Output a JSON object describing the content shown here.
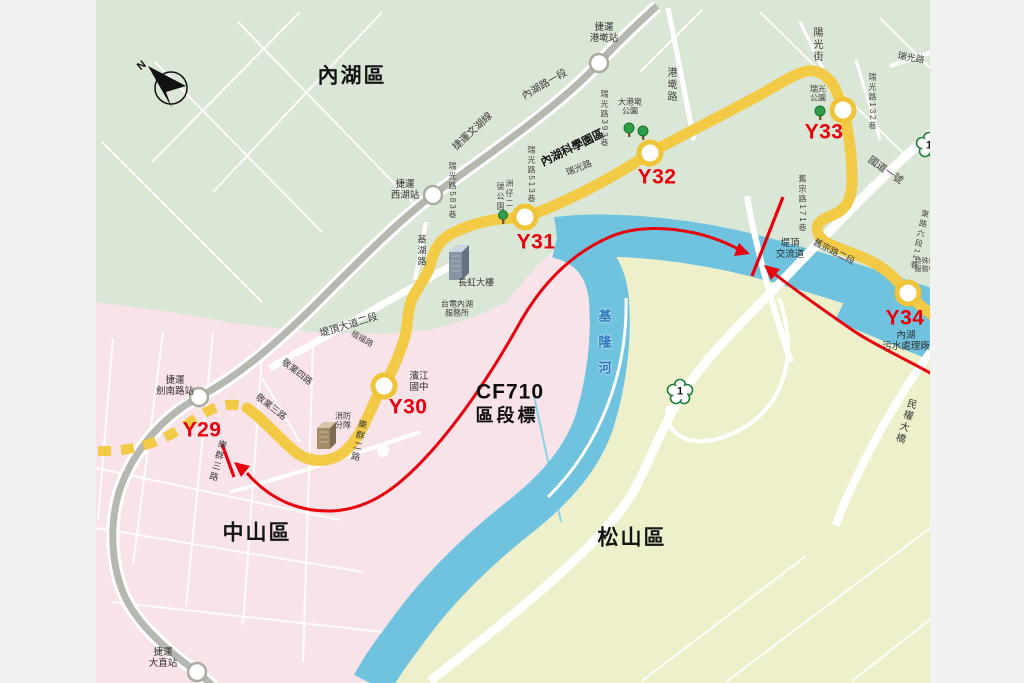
{
  "map_title": "捷運東環段 Y29-Y34 路線圖 (CF710 區段標)",
  "colors": {
    "gutter": "#f0f1f0",
    "neihu_green": "#dbe7d6",
    "zhongshan_pink": "#f8e3e8",
    "songshan_yellowgreen": "#eef0cc",
    "river_blue": "#6fc3df",
    "river_text_blue": "#2e77bc",
    "route_yellow": "#f2ca45",
    "metro_gray": "#b5b8ae",
    "marker_red": "#e8000d",
    "road_white": "#ffffff",
    "ink": "#3a3a3a"
  },
  "districts": [
    "內湖區",
    "中山區",
    "松山區"
  ],
  "route_stations": [
    "Y29",
    "Y30",
    "Y31",
    "Y32",
    "Y33",
    "Y34"
  ],
  "metro_line": "捷運文湖線",
  "metro_stations": [
    "捷運港墘站",
    "捷運西湖站",
    "捷運劍南路站",
    "捷運大直站"
  ],
  "segment_marker": {
    "code": "CF710",
    "label": "區段標"
  },
  "river": "基隆河",
  "labels": [
    {
      "n": "district-neihu",
      "t": "內湖區",
      "x": 352,
      "y": 77,
      "c": "d"
    },
    {
      "n": "district-zhongshan",
      "t": "中山區",
      "x": 257,
      "y": 534,
      "c": "d"
    },
    {
      "n": "district-songshan",
      "t": "松山區",
      "x": 632,
      "y": 539,
      "c": "d"
    },
    {
      "n": "station-y29-label",
      "t": "Y29",
      "x": 202,
      "y": 431,
      "c": "y"
    },
    {
      "n": "station-y30-label",
      "t": "Y30",
      "x": 408,
      "y": 408,
      "c": "y"
    },
    {
      "n": "station-y31-label",
      "t": "Y31",
      "x": 536,
      "y": 243,
      "c": "y"
    },
    {
      "n": "station-y32-label",
      "t": "Y32",
      "x": 657,
      "y": 178,
      "c": "y"
    },
    {
      "n": "station-y33-label",
      "t": "Y33",
      "x": 824,
      "y": 133,
      "c": "y"
    },
    {
      "n": "station-y34-label",
      "t": "Y34",
      "x": 905,
      "y": 319,
      "c": "y"
    },
    {
      "n": "cf710-code",
      "t": "CF710",
      "x": 510,
      "y": 393,
      "c": "cf1"
    },
    {
      "n": "cf710-label",
      "t": "區段標",
      "x": 507,
      "y": 416,
      "c": "cf2"
    },
    {
      "n": "river-label",
      "t": "基隆河",
      "x": 604,
      "y": 348,
      "c": "riv v"
    },
    {
      "n": "mrt-gangqian-label",
      "t": "捷運\n港墘站",
      "x": 604,
      "y": 33,
      "c": "m"
    },
    {
      "n": "mrt-xihu-label",
      "t": "捷運\n西湖站",
      "x": 405,
      "y": 190,
      "c": "m"
    },
    {
      "n": "mrt-jiannan-label",
      "t": "捷運\n劍南路站",
      "x": 175,
      "y": 386,
      "c": "m"
    },
    {
      "n": "mrt-dazhi-label",
      "t": "捷運\n大直站",
      "x": 163,
      "y": 658,
      "c": "m"
    },
    {
      "n": "road-neihu-rd-sec1",
      "t": "內湖路一段",
      "x": 545,
      "y": 85,
      "r": -30,
      "c": "r"
    },
    {
      "n": "mrt-wenhu-line-label",
      "t": "捷運文湖線",
      "x": 473,
      "y": 132,
      "r": -43,
      "c": "r"
    },
    {
      "n": "neihu-tech-park-label",
      "t": "內湖科學園區",
      "x": 573,
      "y": 149,
      "r": -26,
      "c": "bk"
    },
    {
      "n": "road-ruiguang-mid",
      "t": "瑞光路",
      "x": 579,
      "y": 168,
      "r": -22,
      "c": "r9"
    },
    {
      "n": "road-ruiguang-lane393",
      "t": "瑞光路393巷",
      "x": 604,
      "y": 119,
      "c": "r8 v"
    },
    {
      "n": "road-ruiguang-lane513",
      "t": "瑞光路513巷",
      "x": 531,
      "y": 175,
      "c": "r8 v"
    },
    {
      "n": "road-ruiguang-lane583",
      "t": "瑞光路583巷",
      "x": 452,
      "y": 191,
      "c": "r8 v"
    },
    {
      "n": "zhouzai-park-label-a",
      "t": "洲仔二",
      "x": 509,
      "y": 194,
      "c": "r8 v"
    },
    {
      "n": "zhouzai-park-label-b",
      "t": "號公園",
      "x": 500,
      "y": 197,
      "c": "r8 v"
    },
    {
      "n": "road-jihu",
      "t": "基湖路",
      "x": 421,
      "y": 251,
      "c": "r9 v"
    },
    {
      "n": "road-gangqian",
      "t": "港墘路",
      "x": 670,
      "y": 85,
      "c": "r v"
    },
    {
      "n": "dagangqian-park-label",
      "t": "大港墘\n公園",
      "x": 630,
      "y": 107,
      "c": "m8"
    },
    {
      "n": "road-yangguang-st",
      "t": "陽光街",
      "x": 816,
      "y": 45,
      "c": "r v"
    },
    {
      "n": "road-ruiguang-ne",
      "t": "瑞光路",
      "x": 911,
      "y": 58,
      "r": 10,
      "c": "r9"
    },
    {
      "n": "road-ruiguang-lane132",
      "t": "瑞光路132巷",
      "x": 872,
      "y": 102,
      "c": "r8 v"
    },
    {
      "n": "ruiguang-park-label",
      "t": "瑞光\n公園",
      "x": 818,
      "y": 94,
      "c": "m8"
    },
    {
      "n": "road-national-hwy1",
      "t": "國道一號",
      "x": 885,
      "y": 171,
      "r": 35,
      "c": "r"
    },
    {
      "n": "road-jiuzong-lane171",
      "t": "舊宗路171巷",
      "x": 802,
      "y": 204,
      "c": "r8 v"
    },
    {
      "n": "road-jiuzong-sec2",
      "t": "舊宗路二段",
      "x": 834,
      "y": 252,
      "r": 27,
      "c": "r9"
    },
    {
      "n": "tiding-interchange-label",
      "t": "堤頂\n交流道",
      "x": 790,
      "y": 249,
      "c": "m"
    },
    {
      "n": "road-minquan-e-sec6-lane11",
      "t": "東路六段11巷",
      "x": 919,
      "y": 240,
      "r": 12,
      "c": "r8 v"
    },
    {
      "n": "special-service-center-label",
      "t": "特殊教\n服務中",
      "x": 925,
      "y": 266,
      "c": "t7"
    },
    {
      "n": "neihu-sewage-plant-label",
      "t": "內湖\n污水處理廠",
      "x": 906,
      "y": 341,
      "c": "m"
    },
    {
      "n": "minquan-bridge-label",
      "t": "民權大橋",
      "x": 904,
      "y": 421,
      "r": 18,
      "c": "r v"
    },
    {
      "n": "road-tiding-blvd-sec2",
      "t": "堤頂大道二段",
      "x": 349,
      "y": 326,
      "r": -17,
      "c": "r"
    },
    {
      "n": "road-zhifu",
      "t": "植福路",
      "x": 362,
      "y": 339,
      "r": 30,
      "c": "r8"
    },
    {
      "n": "road-jingye-4",
      "t": "敬業四路",
      "x": 297,
      "y": 372,
      "r": 38,
      "c": "r9"
    },
    {
      "n": "road-jingye-3",
      "t": "敬業三路",
      "x": 271,
      "y": 407,
      "r": 38,
      "c": "r9"
    },
    {
      "n": "road-lequn-3",
      "t": "樂群三路",
      "x": 217,
      "y": 461,
      "r": 15,
      "c": "r9 v"
    },
    {
      "n": "road-lequn-2",
      "t": "樂群二路",
      "x": 358,
      "y": 441,
      "r": 12,
      "c": "r9 v"
    },
    {
      "n": "binjiang-jhs-label",
      "t": "濱江\n國中",
      "x": 419,
      "y": 382,
      "c": "m"
    },
    {
      "n": "taipower-neihu-label",
      "t": "台電內湖\n服務所",
      "x": 457,
      "y": 309,
      "c": "m8"
    },
    {
      "n": "changhong-bldg-label",
      "t": "長虹大樓",
      "x": 476,
      "y": 283,
      "c": "r9"
    },
    {
      "n": "fire-brigade-label",
      "t": "消防\n分隊",
      "x": 343,
      "y": 421,
      "c": "m8"
    },
    {
      "n": "compass-n",
      "t": "N",
      "x": 142,
      "y": 66,
      "r": -40,
      "c": "cn"
    },
    {
      "n": "hwy1-shield-number",
      "t": "1",
      "x": 680,
      "y": 392,
      "c": "sh"
    },
    {
      "n": "hwy1-shield-number-edge",
      "t": "1",
      "x": 929,
      "y": 146,
      "c": "sh"
    }
  ]
}
